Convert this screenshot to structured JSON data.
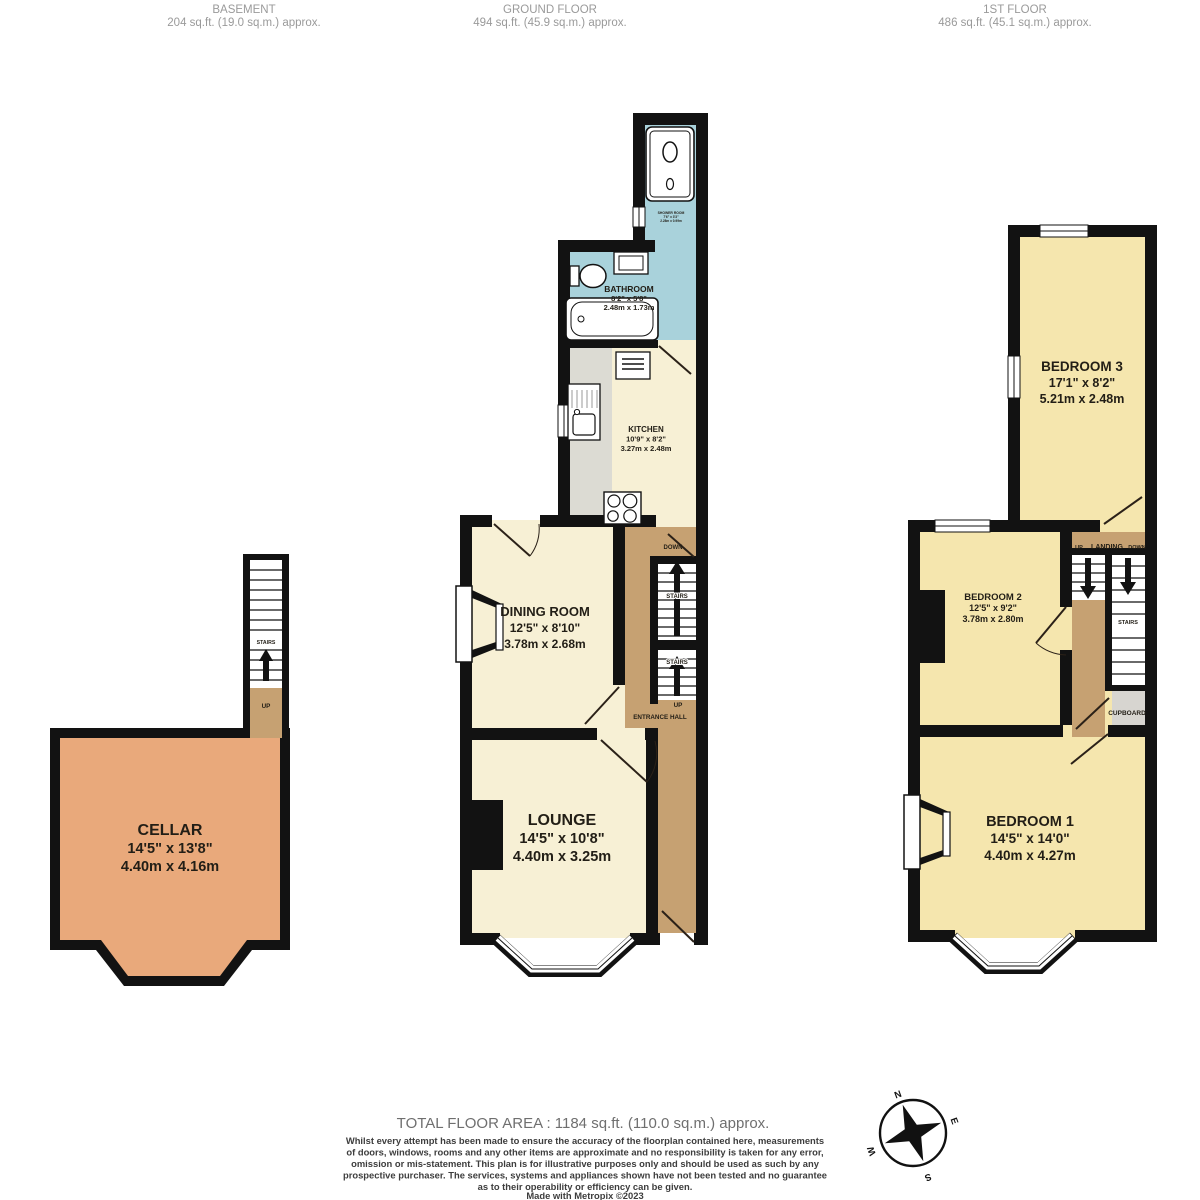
{
  "floors": {
    "basement": {
      "title": "BASEMENT",
      "area": "204 sq.ft. (19.0 sq.m.) approx."
    },
    "ground": {
      "title": "GROUND FLOOR",
      "area": "494 sq.ft. (45.9 sq.m.) approx."
    },
    "first": {
      "title": "1ST FLOOR",
      "area": "486 sq.ft. (45.1 sq.m.) approx."
    }
  },
  "rooms": {
    "cellar": {
      "name": "CELLAR",
      "imperial": "14'5\"  x 13'8\"",
      "metric": "4.40m  x 4.16m"
    },
    "shower": {
      "name": "SHOWER ROOM",
      "imperial": "7'6\" x 3'3\"",
      "metric": "2.28m x 0.99m"
    },
    "bathroom": {
      "name": "BATHROOM",
      "imperial": "8'2\"  x 5'8\"",
      "metric": "2.48m  x 1.73m"
    },
    "kitchen": {
      "name": "KITCHEN",
      "imperial": "10'9\"  x 8'2\"",
      "metric": "3.27m  x 2.48m"
    },
    "dining": {
      "name": "DINING ROOM",
      "imperial": "12'5\"  x 8'10\"",
      "metric": "3.78m  x 2.68m"
    },
    "lounge": {
      "name": "LOUNGE",
      "imperial": "14'5\"  x 10'8\"",
      "metric": "4.40m  x 3.25m"
    },
    "entrance_hall": {
      "name": "ENTRANCE HALL"
    },
    "bedroom3": {
      "name": "BEDROOM 3",
      "imperial": "17'1\"  x 8'2\"",
      "metric": "5.21m  x 2.48m"
    },
    "bedroom2": {
      "name": "BEDROOM 2",
      "imperial": "12'5\"  x 9'2\"",
      "metric": "3.78m  x 2.80m"
    },
    "bedroom1": {
      "name": "BEDROOM 1",
      "imperial": "14'5\"  x 14'0\"",
      "metric": "4.40m  x 4.27m"
    },
    "landing": {
      "name": "LANDING"
    },
    "cupboard": {
      "name": "CUPBOARD"
    }
  },
  "labels": {
    "stairs": "STAIRS",
    "up": "UP",
    "down": "DOWN"
  },
  "compass": {
    "n": "N",
    "e": "E",
    "s": "S",
    "w": "W"
  },
  "footer": {
    "total": "TOTAL FLOOR AREA : 1184 sq.ft. (110.0 sq.m.) approx.",
    "disclaimer_lines": [
      "Whilst every attempt has been made to ensure the accuracy of the floorplan contained here, measurements",
      "of doors, windows, rooms and any other items are approximate and no responsibility is taken for any error,",
      "omission or mis-statement. This plan is for illustrative purposes only and should be used as such by any",
      "prospective purchaser. The services, systems and appliances shown have not been tested and no guarantee",
      "as to their operability or efficiency can be given."
    ],
    "credit": "Made with Metropix ©2023"
  },
  "colors": {
    "wall": "#121212",
    "ground_room": "#F7F0D5",
    "wet_room": "#A9D2DB",
    "hall": "#C6A172",
    "cellar": "#E9A97B",
    "bedroom": "#F5E6AE",
    "counter": "#DCDBD3",
    "cupboard": "#D7D5D0"
  }
}
